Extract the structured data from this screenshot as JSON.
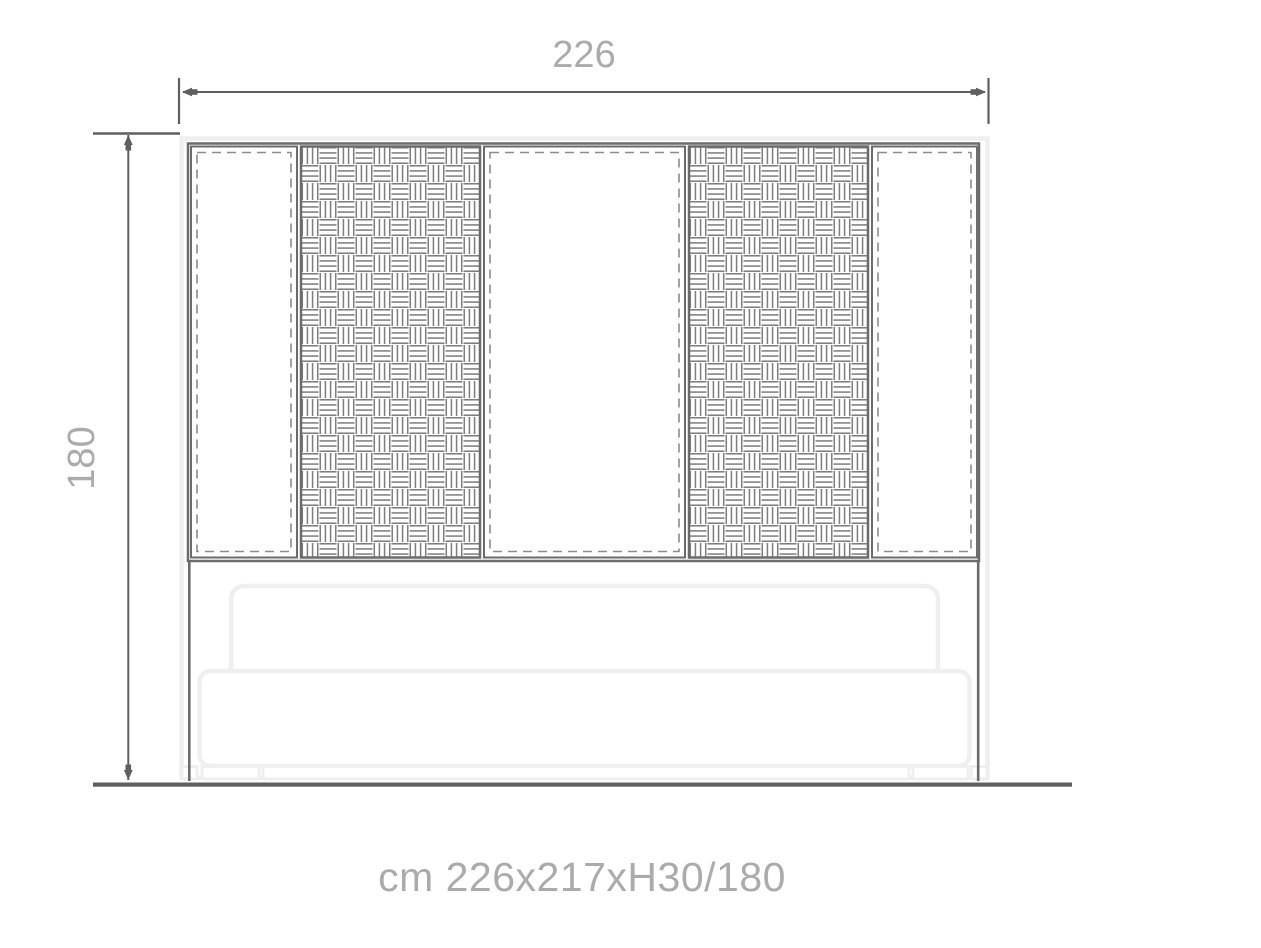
{
  "drawing": {
    "top_dimension_label": "226",
    "left_dimension_label": "180",
    "caption": "cm 226x217xH30/180"
  },
  "colors": {
    "dimension_lines": "#5f5f5f",
    "panel_frame": "#6b6b6b",
    "basket_weave": "#7f7f7f",
    "dashed_inset": "#8c8c8c",
    "upholstery_outline": "#efefef",
    "dimension_text": "#ababab",
    "background": "#ffffff"
  },
  "panels": [
    {
      "position": 1,
      "style": "plain-dashed"
    },
    {
      "position": 2,
      "style": "basket-weave"
    },
    {
      "position": 3,
      "style": "plain-dashed"
    },
    {
      "position": 4,
      "style": "basket-weave"
    },
    {
      "position": 5,
      "style": "plain-dashed"
    }
  ]
}
